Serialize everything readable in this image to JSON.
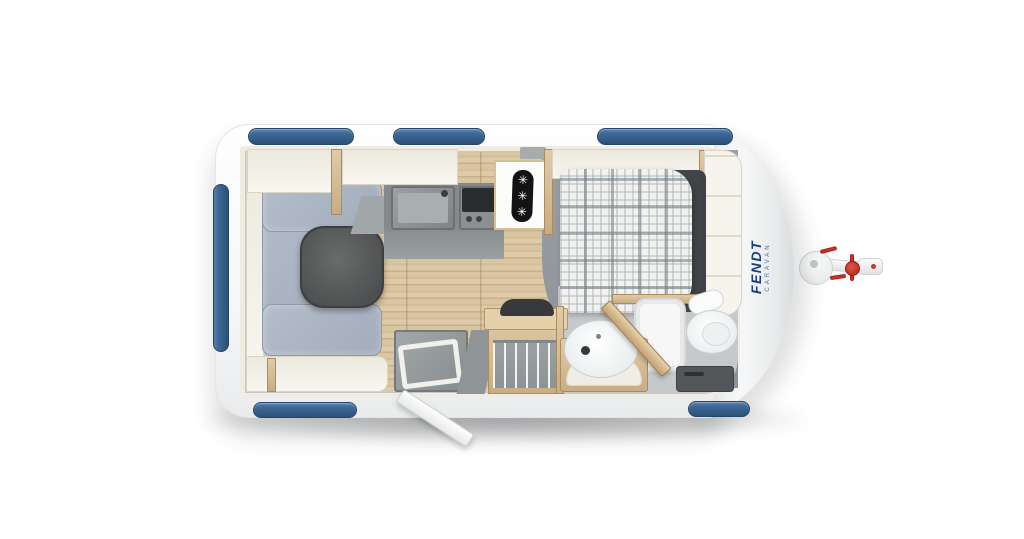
{
  "branding": {
    "logo": "FENDT",
    "sub": "CARAVAN"
  },
  "fridge": {
    "snowflakes": [
      "✳",
      "✳",
      "✳"
    ]
  },
  "colors": {
    "brand-blue": "#1d3e7e",
    "brand-sub": "#486c9e",
    "accent-red": "#cf3125",
    "window-blue": "#3c6796",
    "wall-cream": "#efece1",
    "wood-light": "#dcc7a1",
    "floor-gray": "#c4c7c9",
    "platform-gray": "#939a9f",
    "cushion-gray-blue": "#aab4c3",
    "table-dark": "#535557",
    "counter-gray": "#85898c",
    "cooktop-black": "#2a2d2f",
    "duvet-dark": "#45494d",
    "body-white": "#ffffff"
  }
}
